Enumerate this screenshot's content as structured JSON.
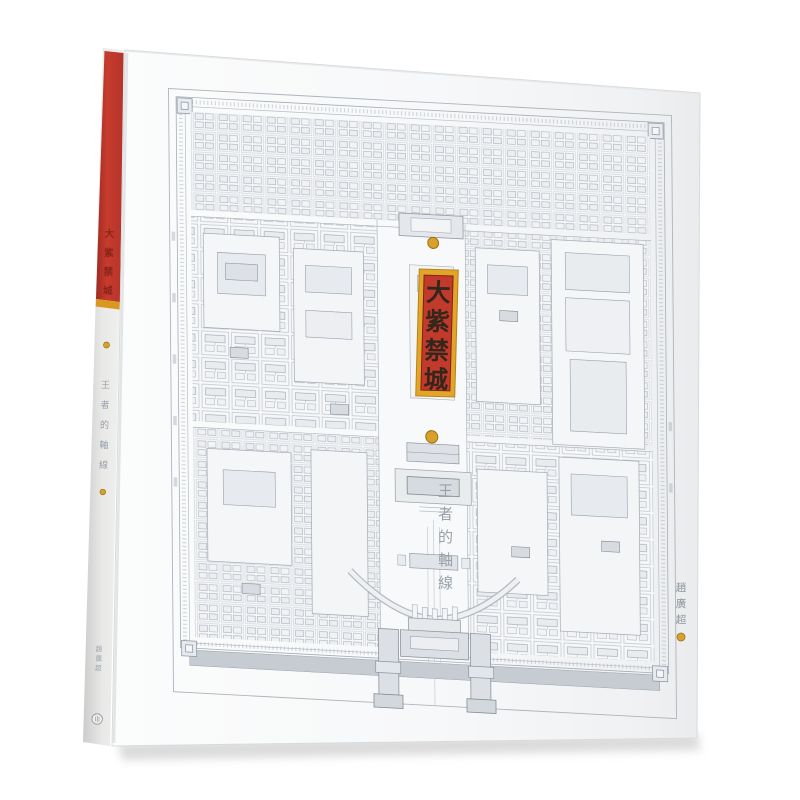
{
  "book": {
    "front_cover": {
      "title_vertical": [
        "大",
        "紫",
        "禁",
        "城"
      ],
      "subtitle_vertical": [
        "王",
        "者",
        "的",
        "軸",
        "線"
      ],
      "author_vertical": [
        "趙",
        "廣",
        "超"
      ]
    },
    "spine": {
      "title_vertical": [
        "大",
        "紫",
        "禁",
        "城"
      ],
      "subtitle_vertical": [
        "王",
        "者",
        "的",
        "軸",
        "線"
      ],
      "author_vertical": [
        "趙",
        "廣",
        "超"
      ]
    },
    "accents": {
      "frame_gold": "#e2a527",
      "panel_red": "#c23a2c",
      "spine_red": "#c0392b",
      "dot_gold": "#d9a02a",
      "map_line_gray": "#a6adb6"
    }
  }
}
